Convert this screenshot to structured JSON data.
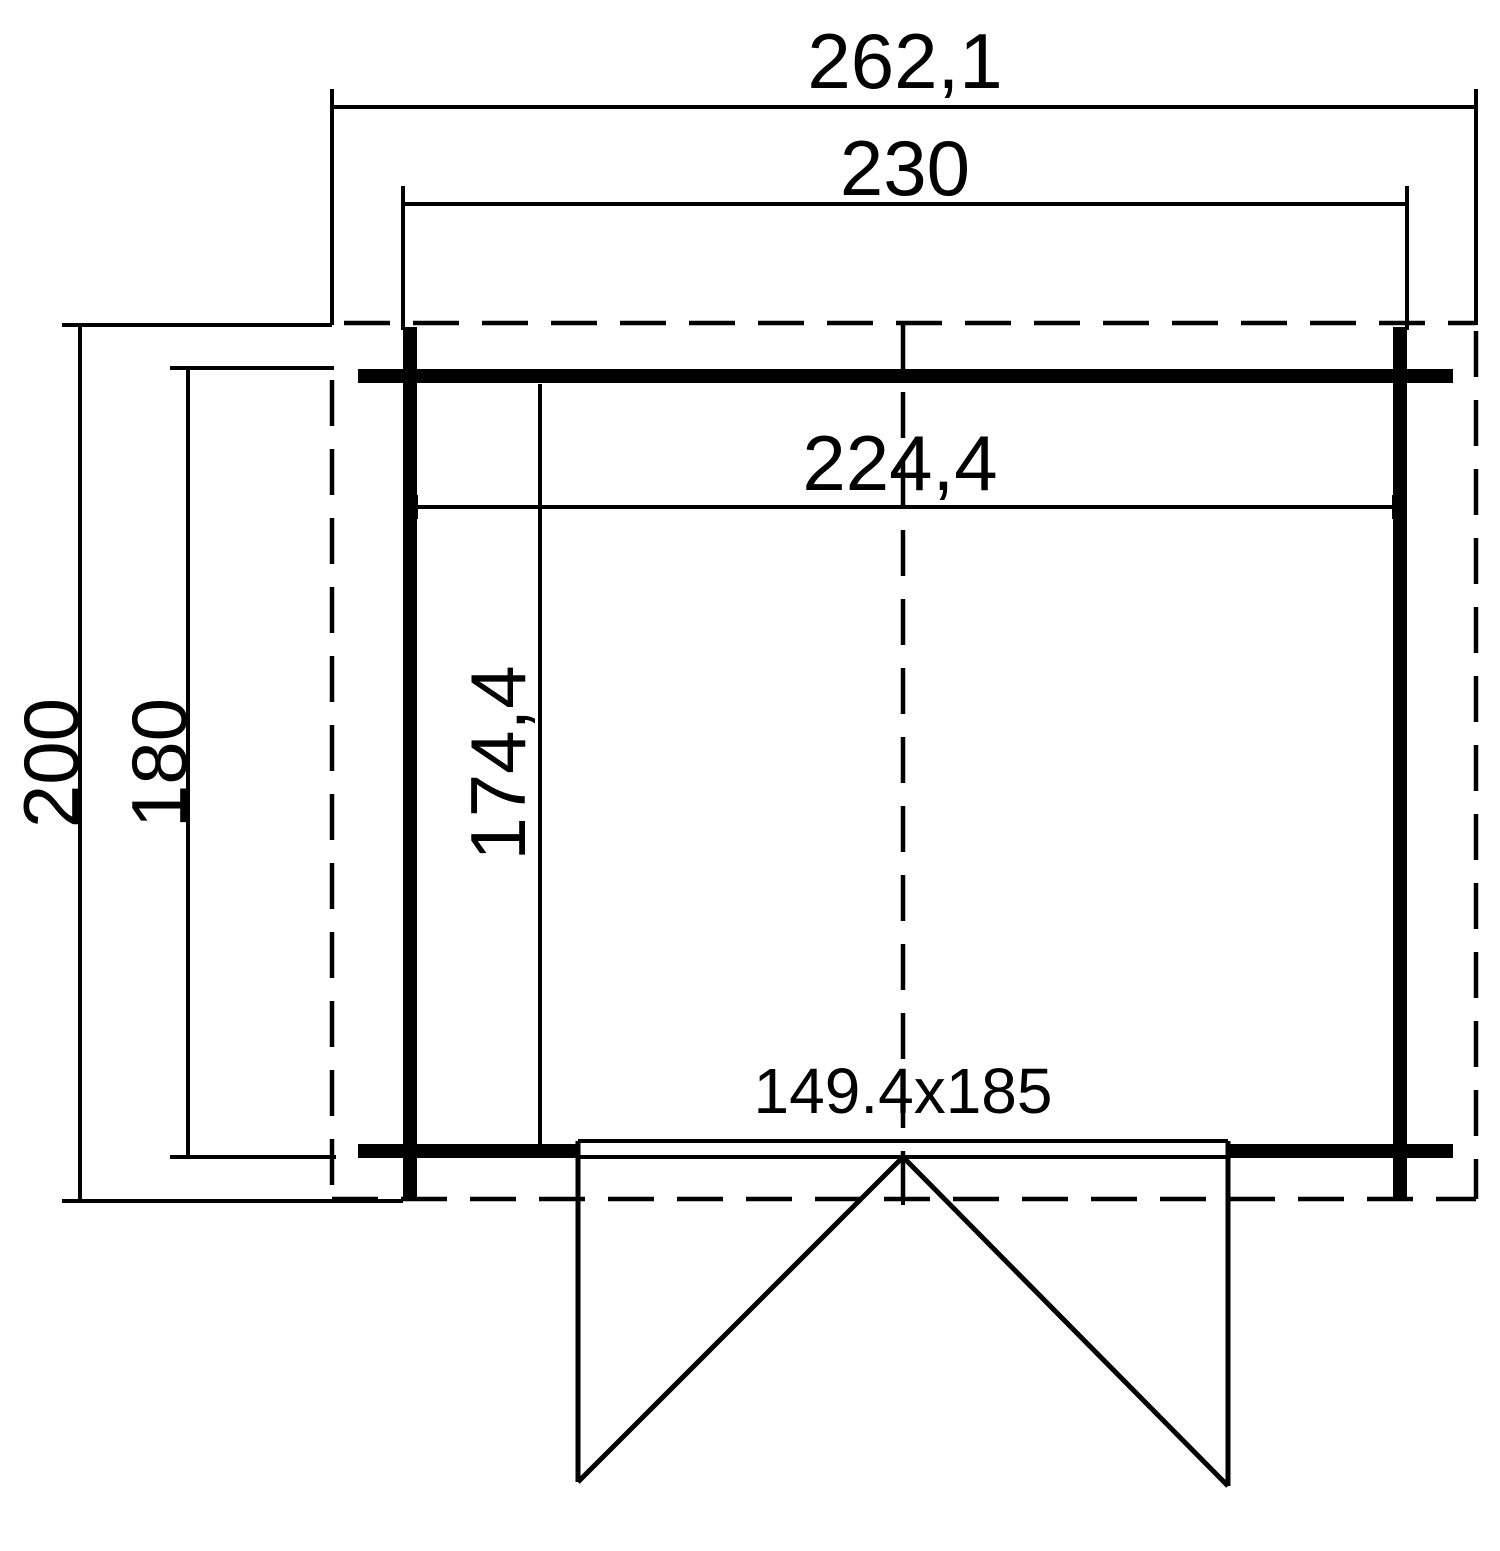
{
  "drawing": {
    "title": "shed-floor-plan",
    "background_color": "#ffffff",
    "line_color": "#000000",
    "labels": {
      "overall_width": "262,1",
      "wall_outer_width": "230",
      "inner_width": "224,4",
      "inner_depth": "174,4",
      "overall_depth": "200",
      "wall_outer_depth": "180",
      "door_size": "149.4x185"
    }
  }
}
